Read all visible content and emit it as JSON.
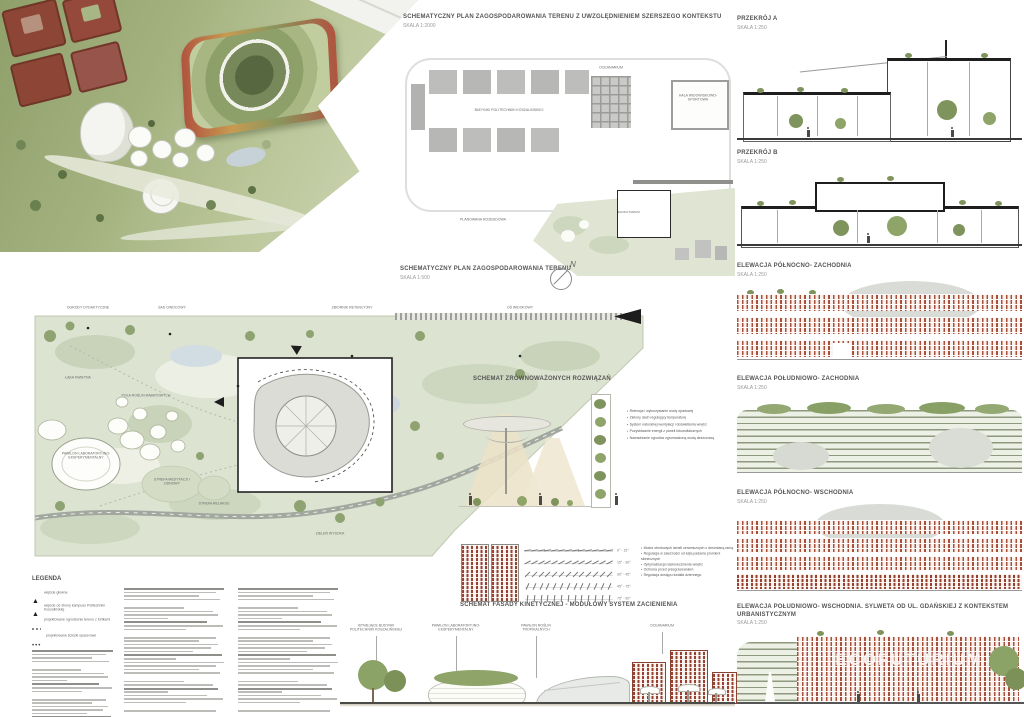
{
  "titles": {
    "context_plan": {
      "t": "SCHEMATYCZNY PLAN ZAGOSPODAROWANIA TERENU Z UWZGLĘDNIENIEM SZERSZEGO KONTEKSTU",
      "s": "SKALA 1:2000"
    },
    "site_plan": {
      "t": "SCHEMATYCZNY PLAN ZAGOSPODAROWANIA TERENU",
      "s": "SKALA 1:500"
    },
    "sustainable": {
      "t": "SCHEMAT ZRÓWNOWAŻONYCH ROZWIĄZAŃ"
    },
    "kinetic": {
      "t": "SCHEMAT FASADY KINETYCZNEJ - MODUŁOWY SYSTEM ZACIENIENIA"
    },
    "section_a": {
      "t": "PRZEKRÓJ A",
      "s": "SKALA 1:250"
    },
    "section_b": {
      "t": "PRZEKRÓJ B",
      "s": "SKALA 1:250"
    },
    "elev_nw": {
      "t": "ELEWACJA PÓŁNOCNO- ZACHODNIA",
      "s": "SKALA 1:250"
    },
    "elev_sw": {
      "t": "ELEWACJA POŁUDNIOWO- ZACHODNIA",
      "s": "SKALA 1:250"
    },
    "elev_ne": {
      "t": "ELEWACJA PÓŁNOCNO- WSCHODNIA",
      "s": "SKALA 1:250"
    },
    "elev_se": {
      "t": "ELEWACJA POŁUDNIOWO- WSCHODNIA. SYLWETA OD UL. GDAŃSKIEJ Z KONTEKSTEM URBANISTYCZNYM",
      "s": "SKALA 1:250"
    }
  },
  "context_plan": {
    "labels": {
      "campus": "BUDYNKI POLITECHNIKI KOSZALIŃSKIEJ",
      "oceanarium": "OCEANARIUM",
      "hala": "HALA WIDOWISKOWO- SPORTOWA",
      "rozbudowa": "PLANOWANA ROZBUDOWA",
      "building": "ECOFUTURIUM"
    }
  },
  "site_plan": {
    "north": "N",
    "labels": [
      "OGRODY DYDAKTYCZNE",
      "SAD OWOCOWY",
      "ZBIORNIK RETENCYJNY",
      "OŚ WIDOKOWY",
      "ŁĄKA KWIETNA",
      "PAWILON LABORATORYJNO- EKSPERYMENTALNY",
      "POLA ROŚLIN RABATOWYCH",
      "STREFA MEDYTACJI I ODNOWY",
      "STREFA RELAKSU",
      "ZIELEŃ WYSOKA"
    ]
  },
  "sustainable": {
    "bullets": [
      "Retencja i wykorzystanie wody opadowej",
      "Zielony dach regulujący temperaturę",
      "System naturalnej wentylacji i doświetlenia wnętrz",
      "Pozyskiwanie energii z paneli fotowoltaicznych",
      "Nawadnianie ogrodów zgromadzoną wodą deszczową"
    ]
  },
  "kinetic": {
    "angles": [
      "0° - 15°",
      "15° - 30°",
      "30° - 45°",
      "45° - 75°",
      "75° - 90°"
    ],
    "bullets": [
      "Moduł obrotowych lameli ceramicznych z drewnianą ramą",
      "Regulacja w zależności od kąta padania promieni słonecznych",
      "Optymalizacja nasłonecznienia wnętrz",
      "Ochrona przed przegrzewaniem",
      "Regulacja dostępu światła dziennego"
    ]
  },
  "legend": {
    "title": "LEGENDA",
    "entries": [
      {
        "text": "wejście główne"
      },
      {
        "text": "wejście od strony kampusu Politechniki Koszalińskiej"
      },
      {
        "text": "projektowane ogrodzenie terenu z furtkami"
      },
      {
        "text": "projektowane ścieżki spacerowe"
      }
    ]
  },
  "bottom": {
    "labels": [
      "ISTNIEJĄCE BUDYNKI POLITECHNIKI KOSZALIŃSKIEJ",
      "PAWILON LABORATORYJNO- EKSPERYMENTALNY",
      "PAWILON ROŚLIN TROPIKALNYCH",
      "OCEANARIUM"
    ]
  },
  "facade_text": "ECOFUTURIUM",
  "colors": {
    "brick": "#a8503c",
    "roof_green": "#6f8757",
    "site_green": "#dde3d1",
    "cone_beige": "#ece2c8"
  }
}
